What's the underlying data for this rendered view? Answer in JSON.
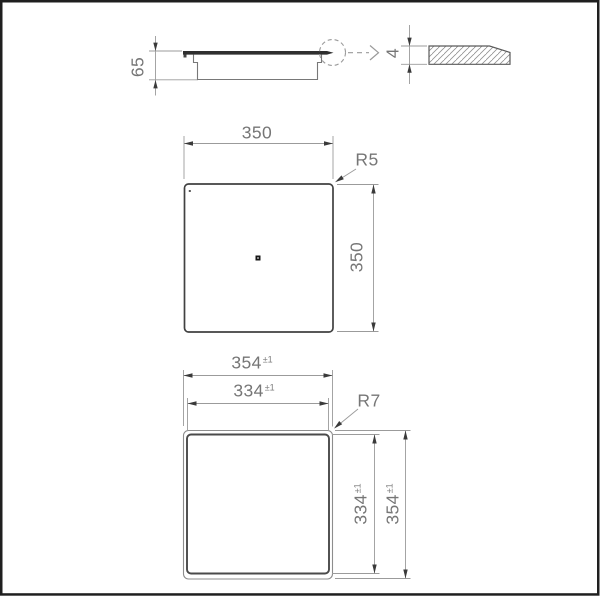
{
  "drawing_type": "technical-dimension-drawing",
  "colors": {
    "background": "#ffffff",
    "frame_border": "#1f1f1f",
    "object_line_dark": "#414141",
    "object_line_light": "#8d8d8d",
    "dimension_line": "#9b9b9b",
    "arrow_fill": "#3a3a3a",
    "text": "#767676",
    "glass_fill": "#2f2f2f"
  },
  "views": {
    "side": {
      "height": "65",
      "glass_thickness": "4"
    },
    "plan": {
      "width": "350",
      "depth": "350",
      "corner_radius": "R5"
    },
    "cutout": {
      "outer_width": "354",
      "outer_width_tol": "±1",
      "inner_width": "334",
      "inner_width_tol": "±1",
      "inner_depth": "334",
      "inner_depth_tol": "±1",
      "outer_depth": "354",
      "outer_depth_tol": "±1",
      "corner_radius": "R7"
    }
  }
}
